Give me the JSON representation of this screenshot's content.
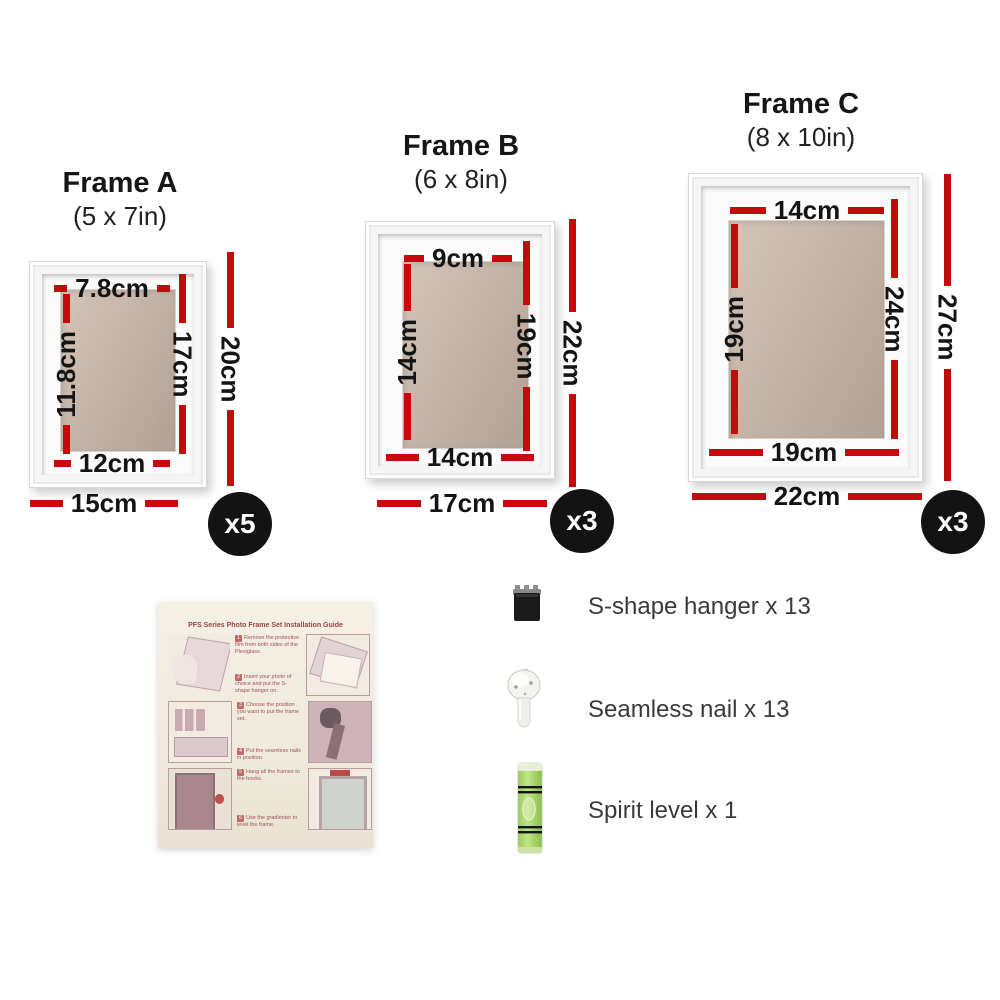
{
  "colors": {
    "dimension_red": "#c40a0a",
    "badge_background": "#131313",
    "badge_text": "#ffffff",
    "photo_backing_tan": "#c0aea1",
    "guide_text_red": "#9c4444"
  },
  "frames": [
    {
      "title": "Frame A",
      "size_label": "(5 x 7in)",
      "qty": "x5",
      "dims": {
        "inner_top": "7.8cm",
        "inner_left": "11.8cm",
        "inner_right": "17cm",
        "inner_bottom": "12cm",
        "outer_width": "15cm",
        "outer_height": "20cm"
      }
    },
    {
      "title": "Frame B",
      "size_label": "(6 x 8in)",
      "qty": "x3",
      "dims": {
        "inner_top": "9cm",
        "inner_left": "14cm",
        "inner_right": "19cm",
        "inner_bottom": "14cm",
        "outer_width": "17cm",
        "outer_height": "22cm"
      }
    },
    {
      "title": "Frame C",
      "size_label": "(8 x 10in)",
      "qty": "x3",
      "dims": {
        "inner_top": "14cm",
        "inner_left": "19cm",
        "inner_right": "24cm",
        "inner_bottom": "19cm",
        "outer_width": "22cm",
        "outer_height": "27cm"
      }
    }
  ],
  "accessories": {
    "items": [
      {
        "label": "S-shape hanger x 13",
        "icon": "s-shape-hanger-icon"
      },
      {
        "label": "Seamless nail x 13",
        "icon": "seamless-nail-icon"
      },
      {
        "label": "Spirit level x 1",
        "icon": "spirit-level-icon"
      }
    ]
  },
  "guide": {
    "title": "PFS Series Photo Frame Set Installation Guide",
    "steps": [
      {
        "num": "1",
        "text": "Remove the protective film from both sides of the Plexiglass."
      },
      {
        "num": "2",
        "text": "Insert your photo of choice and put the S-shape hanger on."
      },
      {
        "num": "3",
        "text": "Choose the position you want to put the frame set."
      },
      {
        "num": "4",
        "text": "Put the seamless nails in position."
      },
      {
        "num": "5",
        "text": "Hang all the frames to the hooks."
      },
      {
        "num": "6",
        "text": "Use the gradienter to level the frame."
      }
    ]
  }
}
